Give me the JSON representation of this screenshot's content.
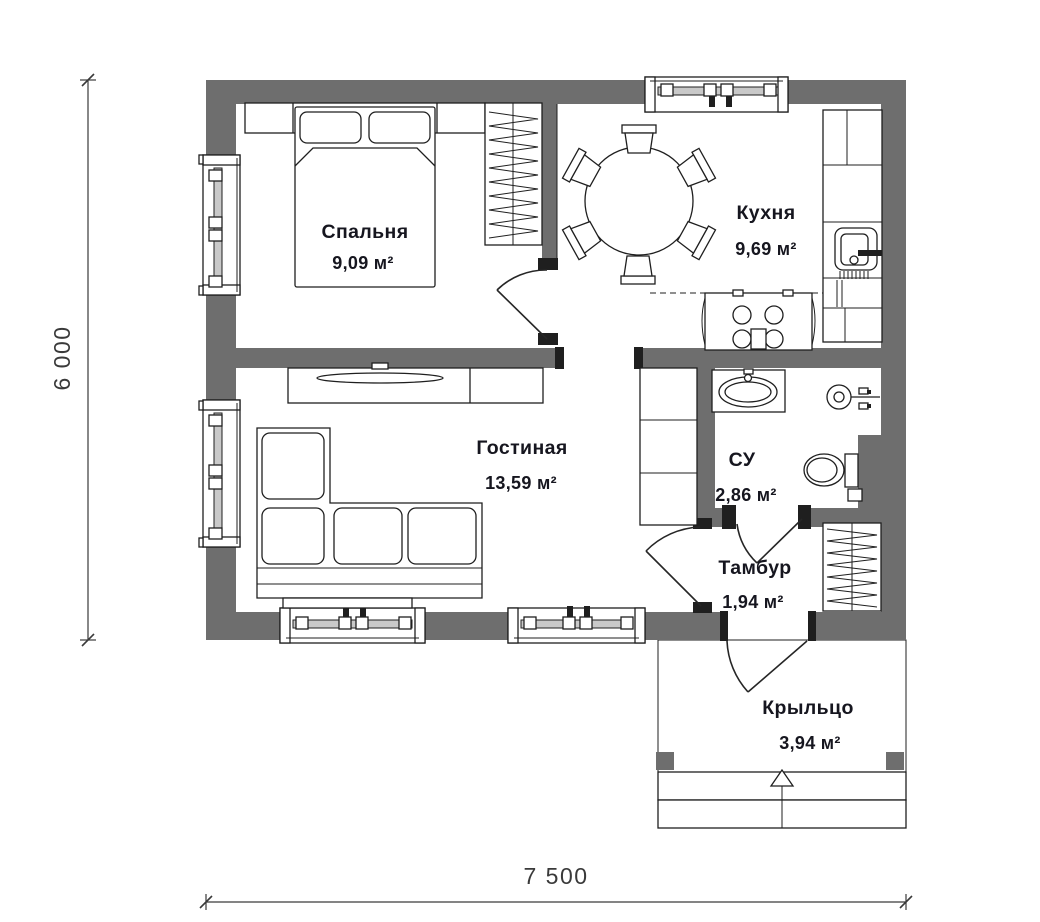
{
  "plan": {
    "rooms": [
      {
        "name": "Спальня",
        "area": "9,09 м²"
      },
      {
        "name": "Кухня",
        "area": "9,69 м²"
      },
      {
        "name": "Гостиная",
        "area": "13,59 м²"
      },
      {
        "name": "СУ",
        "area": "2,86 м²"
      },
      {
        "name": "Тамбур",
        "area": "1,94 м²"
      },
      {
        "name": "Крыльцо",
        "area": "3,94 м²"
      }
    ],
    "dimensions": {
      "width": "7 500",
      "height": "6 000"
    },
    "colors": {
      "wall": "#6e6e6e",
      "line": "#1f1f1f",
      "text": "#16161f",
      "dim": "#3a3a3a",
      "glazing": "#c9c9c9"
    }
  }
}
